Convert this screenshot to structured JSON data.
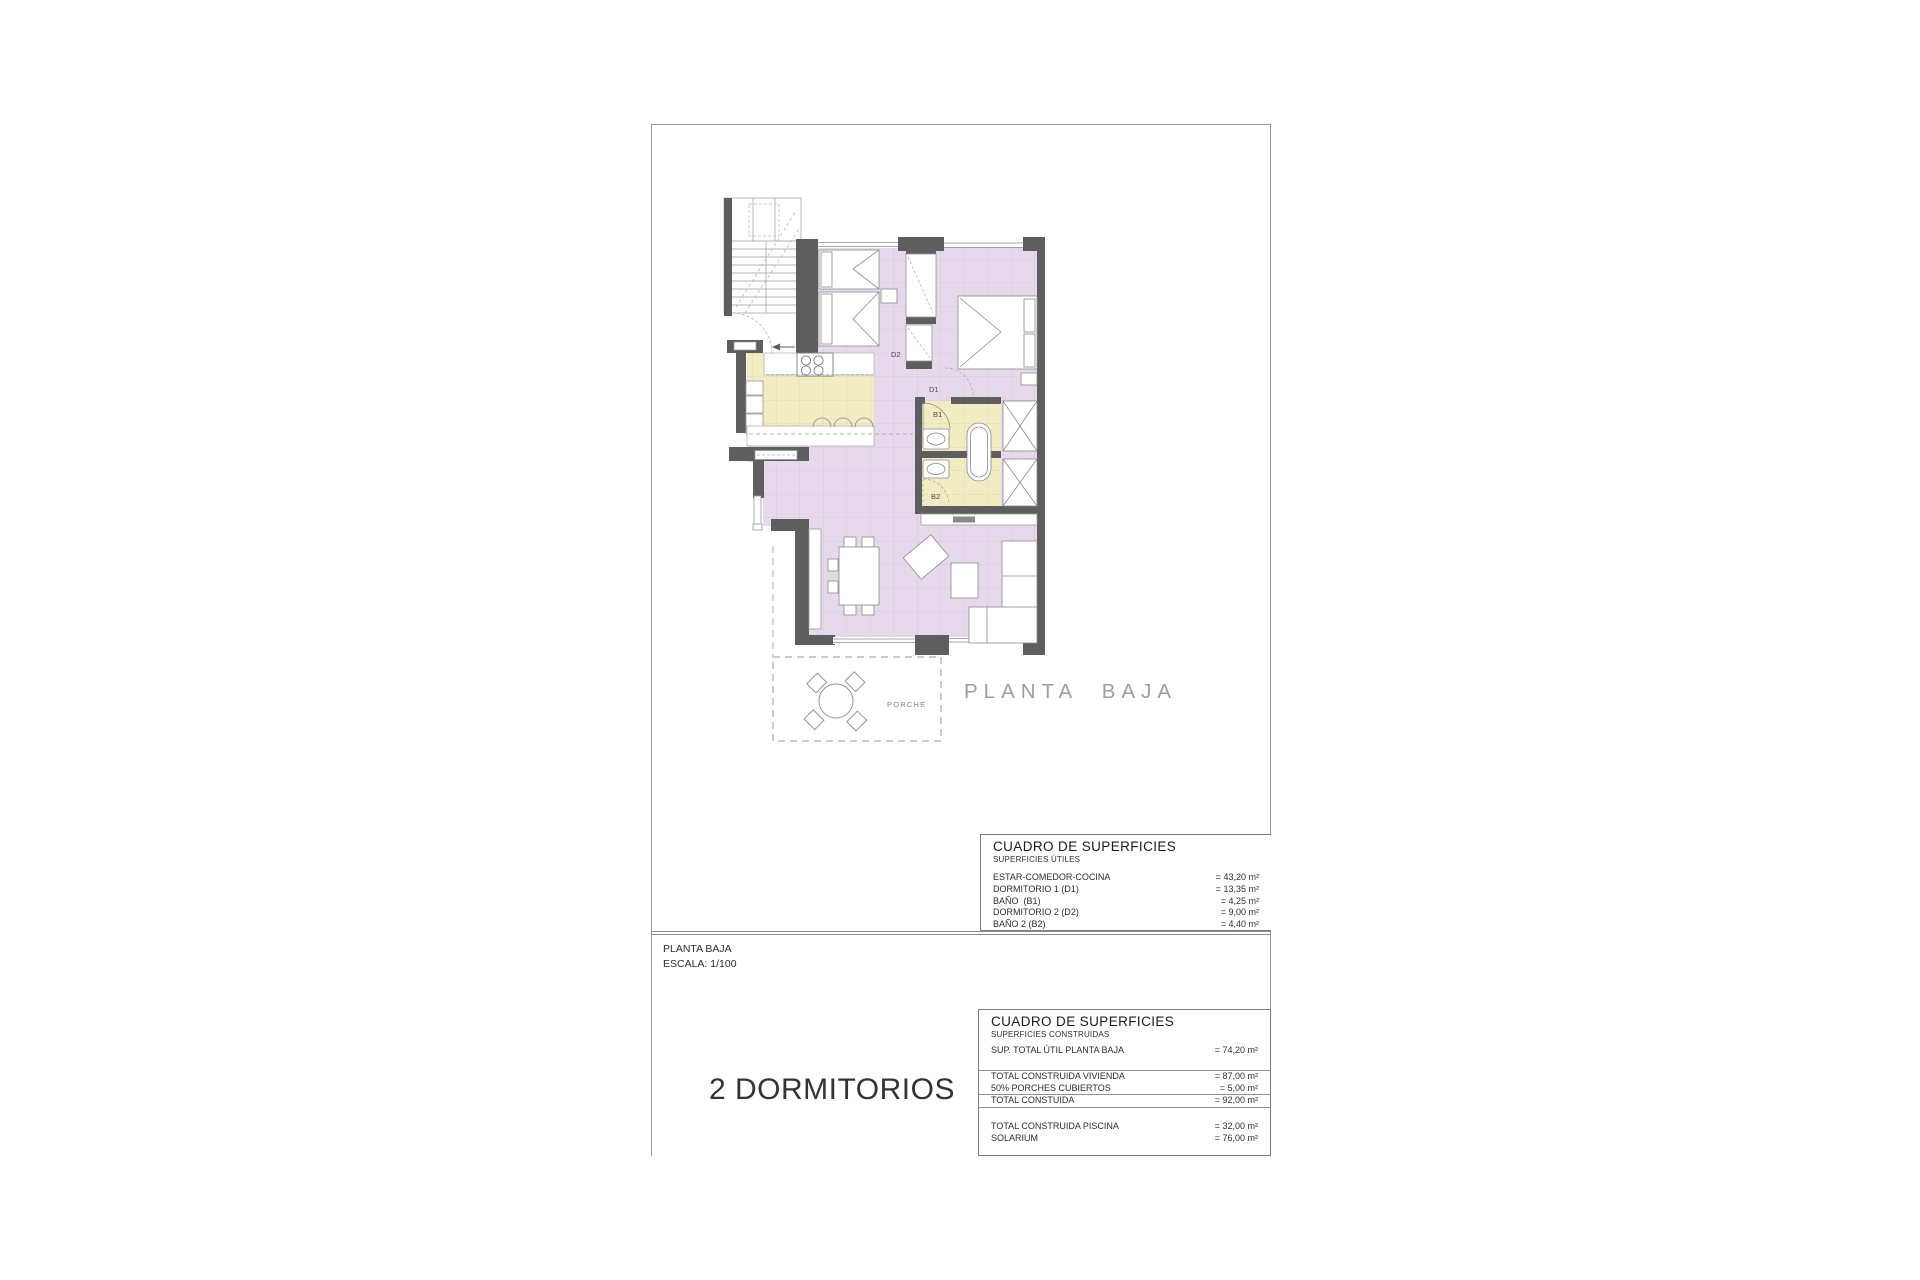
{
  "sheet": {
    "plan": {
      "title_label": "PLANTA BAJA",
      "porch_label": "PORCHE",
      "room_labels": {
        "d1": "D1",
        "d2": "D2",
        "b1": "B1",
        "b2": "B2"
      }
    },
    "surface_table_utiles": {
      "title": "CUADRO DE SUPERFICIES",
      "subtitle": "SUPERFICIES ÚTILES",
      "rows": [
        {
          "label": "ESTAR-COMEDOR-COCINA",
          "value": "= 43,20 m²"
        },
        {
          "label": "DORMITORIO 1 (D1)",
          "value": "= 13,35 m²"
        },
        {
          "label": "BAÑO  (B1)",
          "value": "= 4,25 m²"
        },
        {
          "label": "DORMITORIO 2 (D2)",
          "value": "= 9,00 m²"
        },
        {
          "label": "BAÑO 2 (B2)",
          "value": "= 4,40 m²"
        }
      ]
    },
    "scale_block": {
      "line1": "PLANTA BAJA",
      "line2": "ESCALA: 1/100"
    },
    "variant_label": "2 DORMITORIOS",
    "surface_table_construidas": {
      "title": "CUADRO DE SUPERFICIES",
      "subtitle": "SUPERFICIES CONSTRUIDAS",
      "rows": [
        {
          "label": "SUP. TOTAL ÚTIL PLANTA BAJA",
          "value": "= 74,20 m²",
          "cls": "gap-after"
        },
        {
          "label": "TOTAL CONSTRUIDA VIVIENDA",
          "value": "= 87,00 m²",
          "cls": "rule-above"
        },
        {
          "label": "50% PORCHES CUBIERTOS",
          "value": "= 5,00 m²",
          "cls": ""
        },
        {
          "label": "TOTAL CONSTUIDA",
          "value": "= 92,00 m²",
          "cls": "boxed"
        },
        {
          "label": "TOTAL CONSTRUIDA PISCINA",
          "value": "= 32,00 m²",
          "cls": "gap-before"
        },
        {
          "label": "SOLARIUM",
          "value": "= 76,00 m²",
          "cls": ""
        }
      ]
    },
    "colors": {
      "room_lilac": "#e6d9ec",
      "room_yellow": "#f2ecc3",
      "wall": "#5e5e5e"
    }
  }
}
